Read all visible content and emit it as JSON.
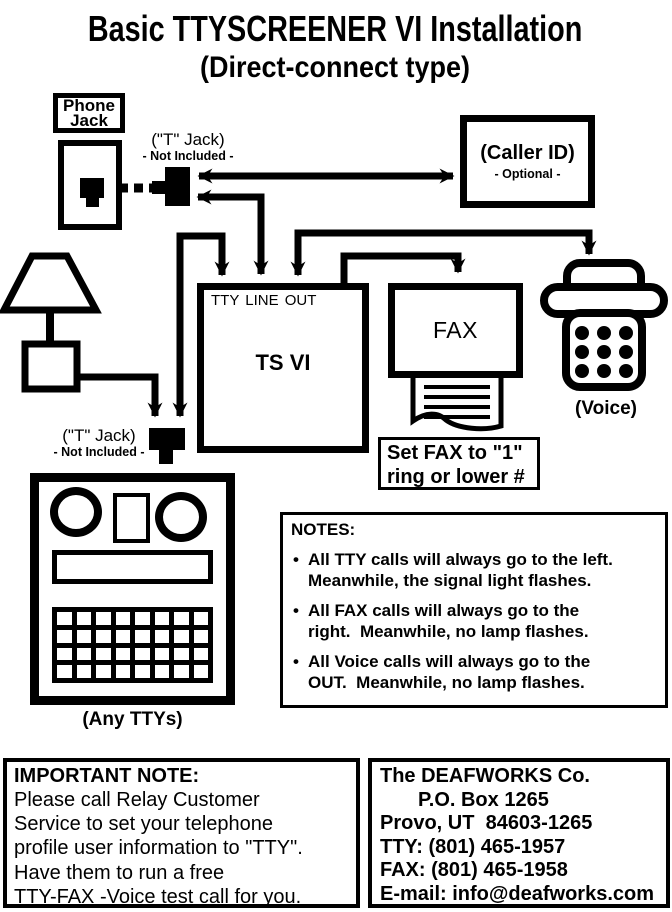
{
  "header": {
    "title": "Basic TTYSCREENER VI Installation",
    "subtitle": "(Direct-connect type)"
  },
  "phone_jack": {
    "label": "Phone\nJack"
  },
  "t_jack_top": {
    "label": "(\"T\" Jack)",
    "note": "- Not Included -"
  },
  "t_jack_bottom": {
    "label": "(\"T\" Jack)",
    "note": "- Not Included -"
  },
  "caller_id": {
    "label": "(Caller ID)",
    "note": "- Optional -"
  },
  "ts_vi": {
    "ports": "TTY LINE OUT",
    "name": "TS VI"
  },
  "fax": {
    "label": "FAX"
  },
  "fax_setting": {
    "line1": "Set FAX to \"1\"",
    "line2": "ring or lower #"
  },
  "voice": {
    "label": "(Voice)"
  },
  "tty": {
    "label": "(Any TTYs)"
  },
  "notes": {
    "heading": "NOTES:",
    "items": [
      {
        "line1": "All TTY calls will always go to the left.",
        "line2": "Meanwhile, the signal light flashes."
      },
      {
        "line1": "All FAX calls will always go to the",
        "line2": "right.  Meanwhile, no lamp flashes."
      },
      {
        "line1": "All Voice calls will always go to the",
        "line2": "OUT.  Meanwhile, no lamp flashes."
      }
    ]
  },
  "important_note": {
    "heading": "IMPORTANT NOTE:",
    "lines": [
      "Please call Relay Customer",
      "Service to set your telephone",
      "profile user information to \"TTY\".",
      "Have them to run a free",
      "TTY-FAX -Voice test call for you."
    ]
  },
  "contact": {
    "line1": "The DEAFWORKS Co.",
    "line2": "P.O. Box 1265",
    "line3": "Provo, UT  84603-1265",
    "line4": "TTY: (801) 465-1957",
    "line5": "FAX: (801) 465-1958",
    "line6": "E-mail: info@deafworks.com"
  },
  "colors": {
    "ink": "#000000",
    "paper": "#ffffff"
  }
}
